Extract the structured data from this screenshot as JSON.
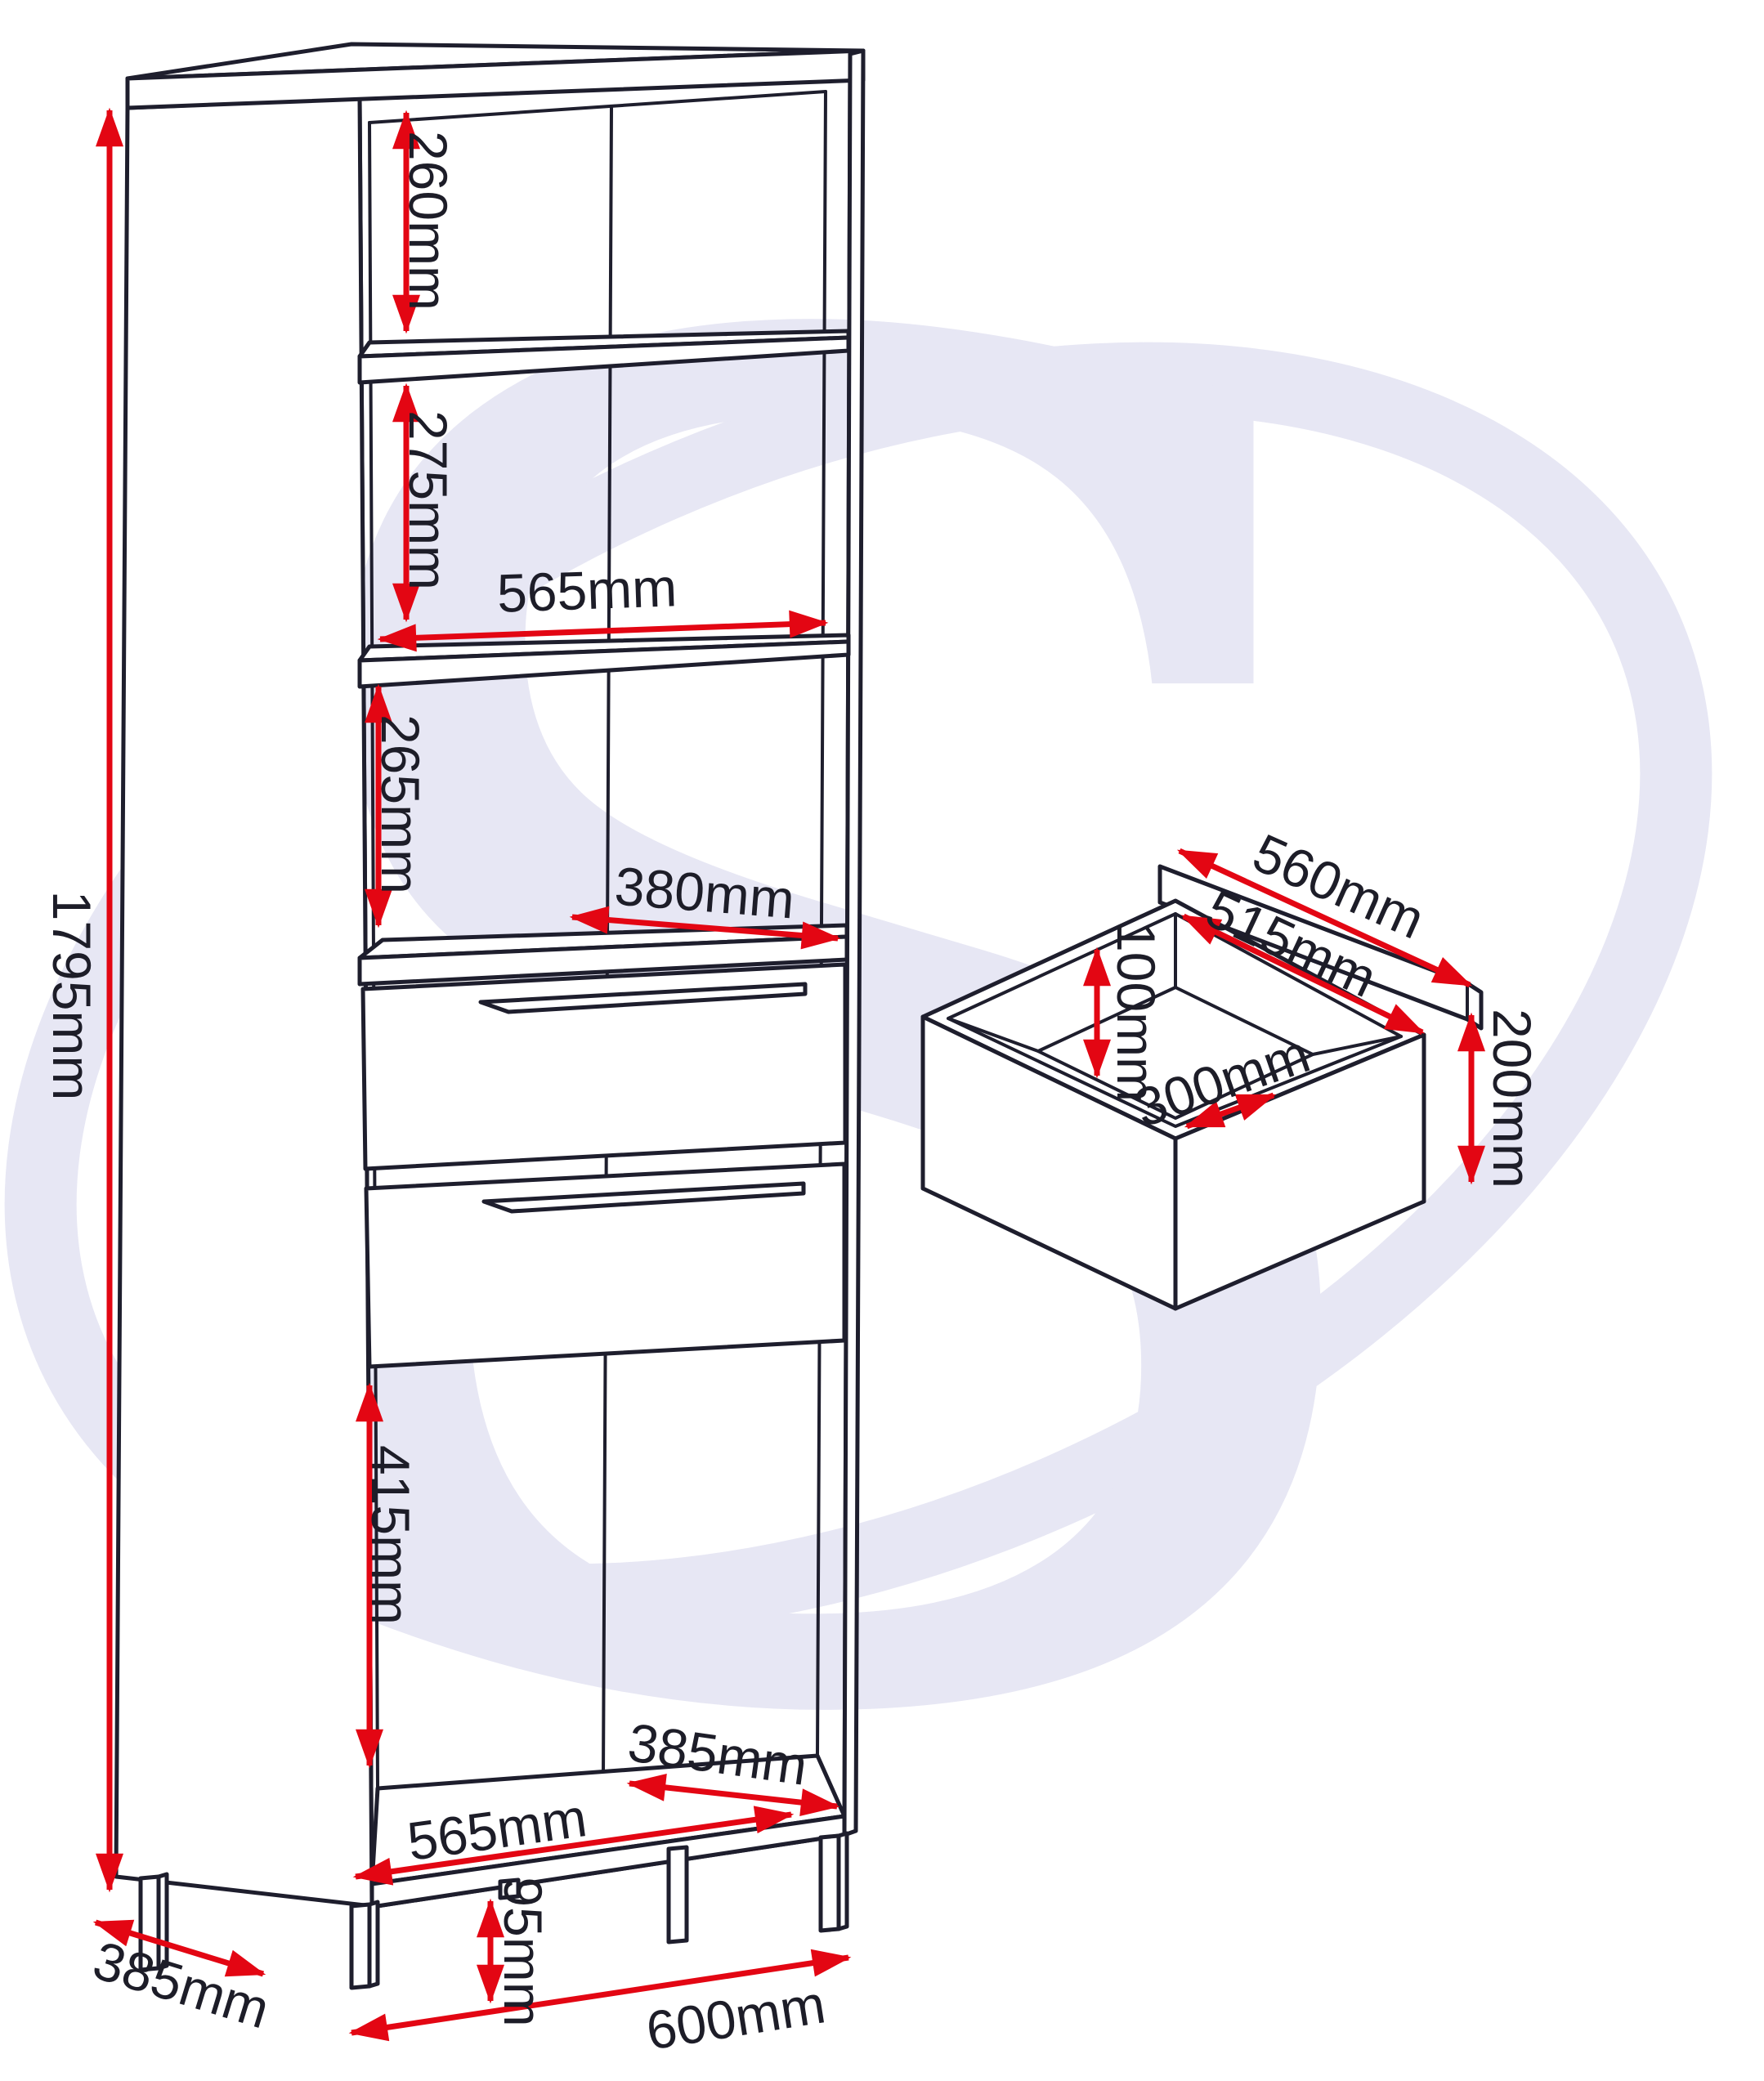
{
  "meta": {
    "title": "Furniture dimension diagram",
    "type": "technical line drawing"
  },
  "colors": {
    "background": "#ffffff",
    "line": "#1e1e2d",
    "dimension_red": "#e30613",
    "watermark": "#e7e7f4",
    "label_text": "#1d1d28"
  },
  "watermark": {
    "letter": "S"
  },
  "cabinet": {
    "name": "Tall shelving unit with two drawers",
    "labels": {
      "total_height": "1795mm",
      "top_shelf_space": "260mm",
      "second_shelf_space": "275mm",
      "interior_width": "565mm",
      "third_shelf_space": "265mm",
      "shelf_depth": "380mm",
      "bottom_space_height": "415mm",
      "interior_depth": "385mm",
      "interior_floor_width": "565mm",
      "leg_height": "95mm",
      "unit_depth": "385mm",
      "unit_width": "600mm"
    }
  },
  "drawer_detail": {
    "name": "Drawer internal dimensions",
    "labels": {
      "back_rail_width": "560mm",
      "inner_width": "515mm",
      "inner_height": "100mm",
      "inner_depth": "300mm",
      "front_height": "200mm"
    }
  }
}
